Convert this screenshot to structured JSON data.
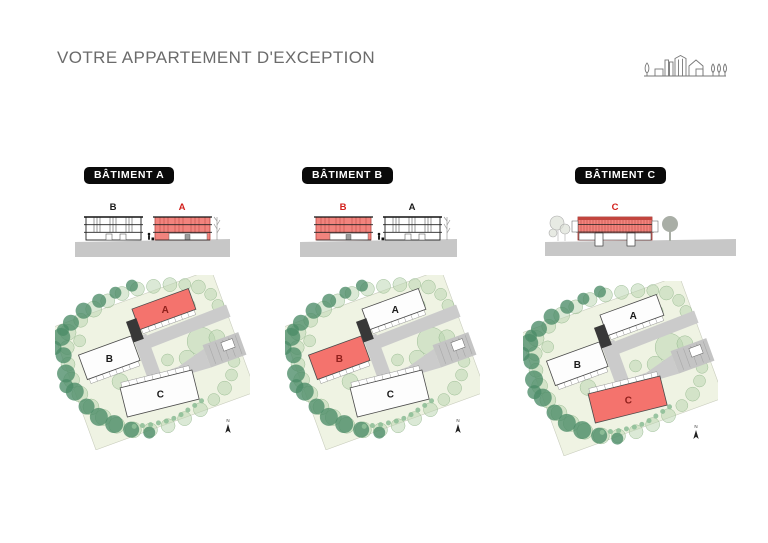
{
  "header": {
    "title": "VOTRE APPARTEMENT D'EXCEPTION",
    "logo_icon": "village-skyline-logo"
  },
  "sections": [
    {
      "badge": "BÂTIMENT A",
      "highlighted_building": "A",
      "elevation": {
        "left_label": "B",
        "right_label": "A"
      }
    },
    {
      "badge": "BÂTIMENT B",
      "highlighted_building": "B",
      "elevation": {
        "left_label": "B",
        "right_label": "A"
      }
    },
    {
      "badge": "BÂTIMENT C",
      "highlighted_building": "C",
      "elevation": {
        "center_label": "C"
      }
    }
  ],
  "site_plan": {
    "labels": {
      "a": "A",
      "b": "B",
      "c": "C"
    },
    "north": "N"
  },
  "colors": {
    "title_gray": "#6B6B6B",
    "badge_bg": "#0A0A0A",
    "badge_text": "#FFFFFF",
    "elevation_red": "#F2837D",
    "elevation_red_dark": "#B5443F",
    "plan_red": "#F4736D",
    "label_red": "#D21F1B",
    "plan_label_red": "#8F201C",
    "ground_gray": "#C7C7C7",
    "plan_ground": "#EFF3E3",
    "road_gray": "#CBCBCB",
    "tree_dark": "#4C8C68",
    "tree_light": "#B7D3AE"
  }
}
